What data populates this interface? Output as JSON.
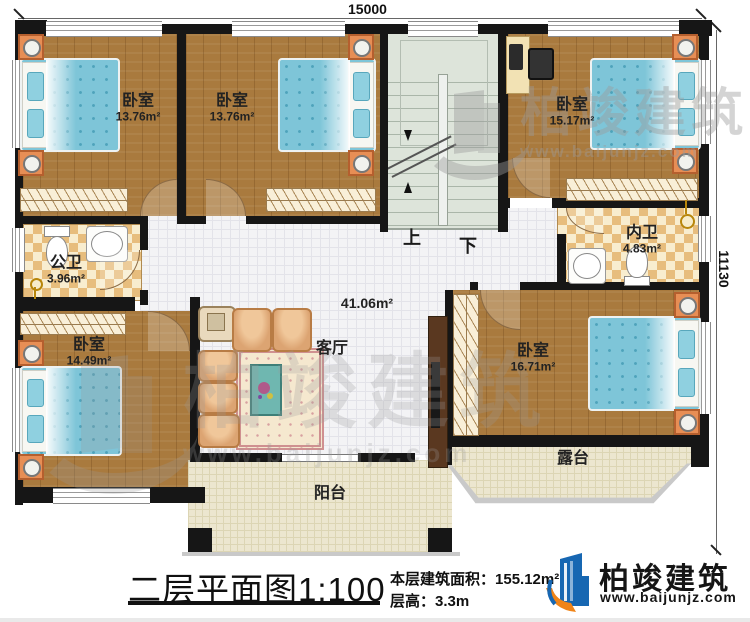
{
  "dimensions": {
    "top": "15000",
    "right": "11130"
  },
  "rooms": {
    "bedroom_tl": {
      "name": "卧室",
      "area": "13.76m²"
    },
    "bedroom_tm": {
      "name": "卧室",
      "area": "13.76m²"
    },
    "bedroom_tr": {
      "name": "卧室",
      "area": "15.17m²"
    },
    "bedroom_bl": {
      "name": "卧室",
      "area": "14.49m²"
    },
    "bedroom_br": {
      "name": "卧室",
      "area": "16.71m²"
    },
    "public_bath": {
      "name": "公卫",
      "area": "3.96m²"
    },
    "ensuite_bath": {
      "name": "内卫",
      "area": "4.83m²"
    },
    "living": {
      "name": "客厅",
      "area": "41.06m²"
    },
    "balcony": {
      "name": "阳台"
    },
    "terrace": {
      "name": "露台"
    }
  },
  "stairs": {
    "up": "上",
    "down": "下"
  },
  "titleblock": {
    "title": "二层平面图",
    "scale": "1:100",
    "area_label": "本层建筑面积：",
    "area_value": "155.12m²",
    "height_label": "层高：",
    "height_value": "3.3m"
  },
  "brand": {
    "name": "柏竣建筑",
    "url": "www.baijunjz.com"
  },
  "watermark": {
    "name": "柏竣建筑",
    "url": "www.baijunjz.com"
  },
  "colors": {
    "wall": "#161616",
    "wood_floor": "#a97a3e",
    "tile_floor": "#f3f3f5",
    "bath_tile": "#e7bd7d",
    "stair": "#dde4da",
    "porch": "#ece6cf",
    "bed": "#7ec5d8",
    "nightstand": "#e78e55",
    "brand_blue": "#1767b2",
    "brand_orange": "#f08418"
  }
}
